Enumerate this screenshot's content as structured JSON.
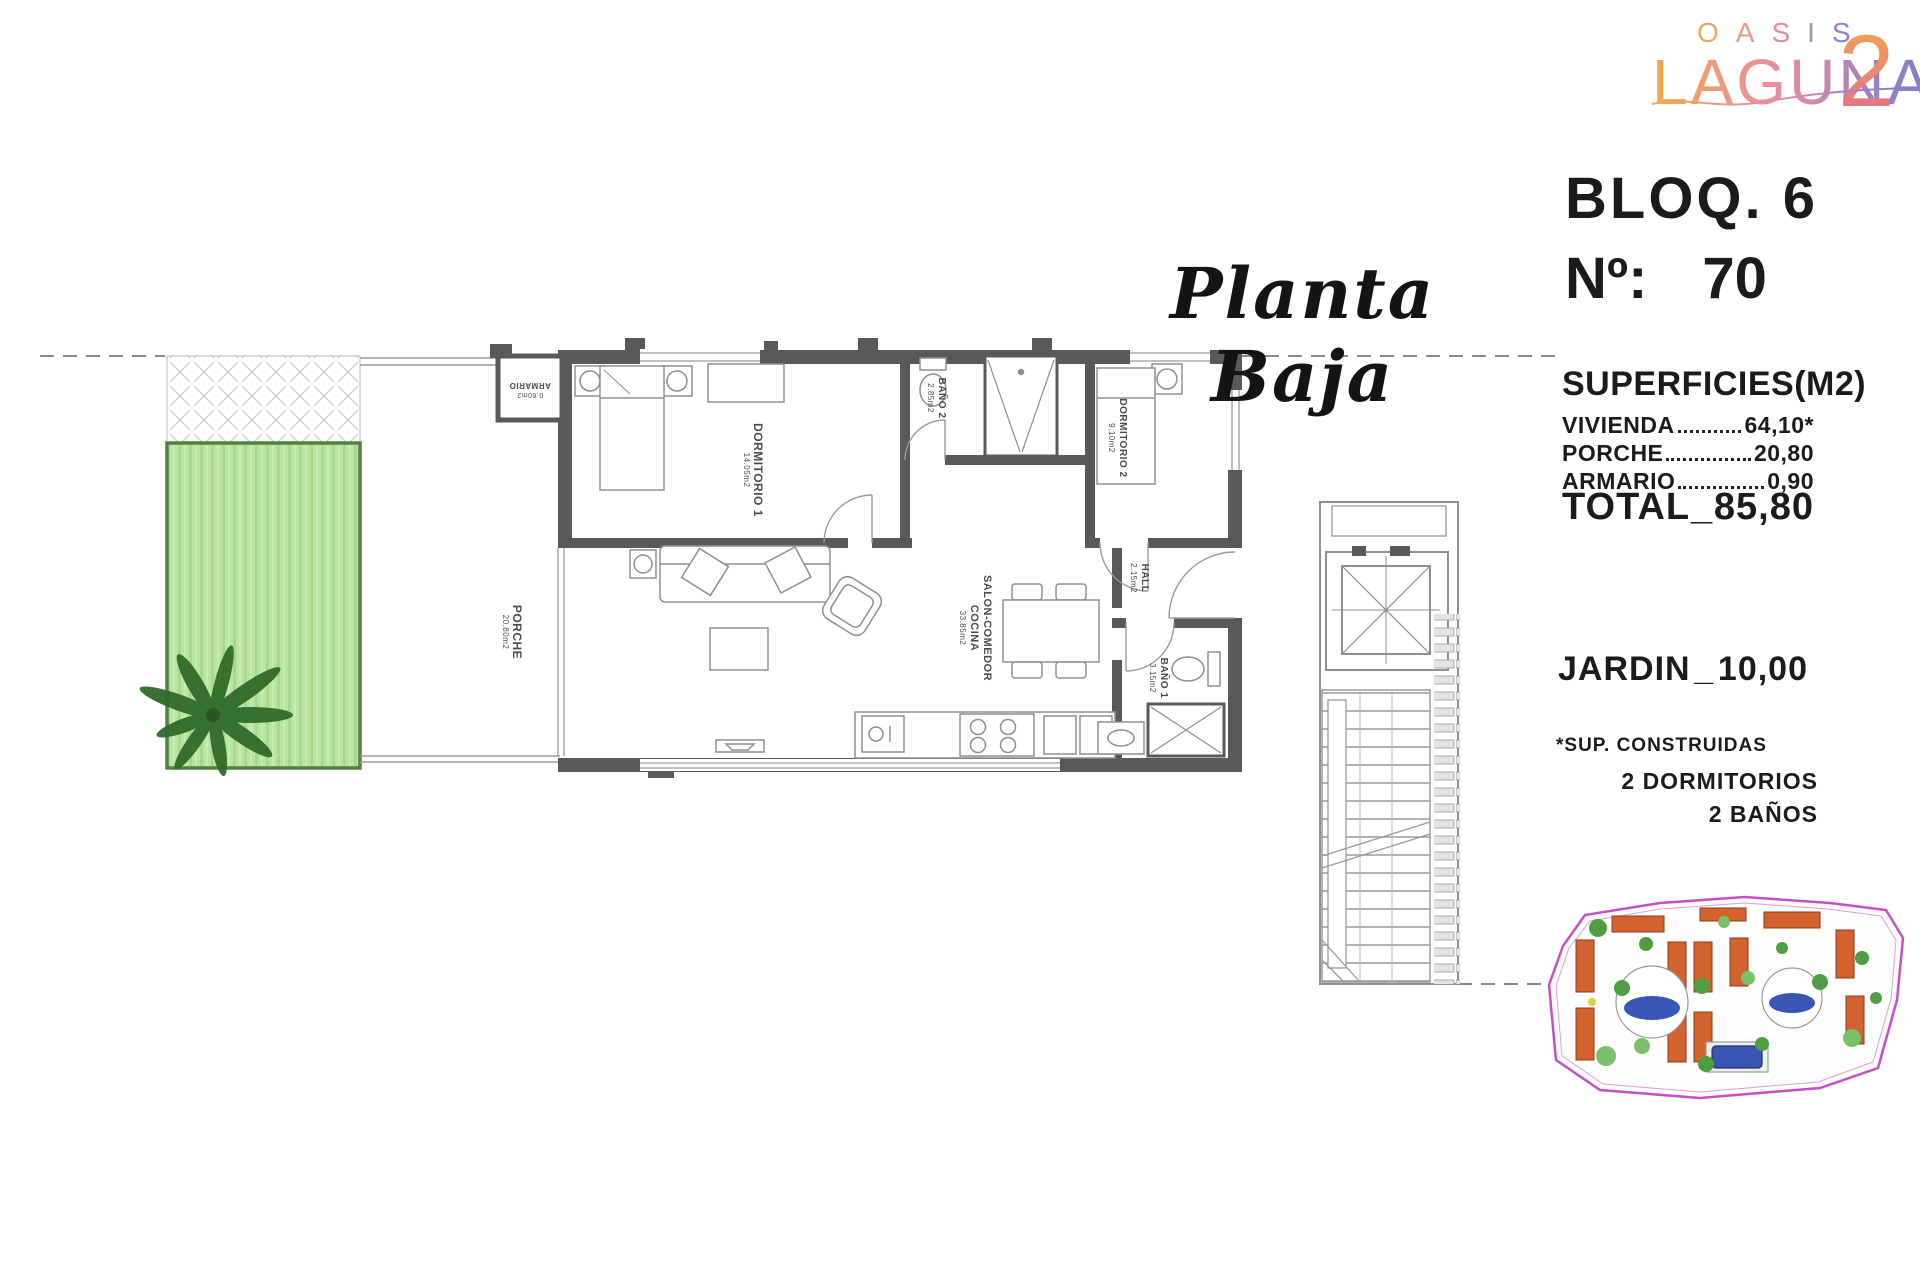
{
  "logo": {
    "word1": "OASIS",
    "word2": "LAGUNA",
    "number": "2"
  },
  "title": {
    "plan": "Planta Baja"
  },
  "unit_panel": {
    "block": "BLOQ. 6",
    "number_label": "Nº:",
    "number": "70"
  },
  "surfaces": {
    "header": "SUPERFICIES(M2)",
    "rows": [
      {
        "label": "VIVIENDA",
        "value": "64,10*"
      },
      {
        "label": "PORCHE",
        "value": "20,80"
      },
      {
        "label": "ARMARIO",
        "value": "0,90"
      }
    ],
    "total": {
      "label": "TOTAL",
      "sep": "_",
      "value": "85,80"
    },
    "garden": {
      "label": "JARDIN",
      "sep": "_",
      "value": "10,00"
    },
    "footnote": "*SUP. CONSTRUIDAS",
    "features": [
      "2 DORMITORIOS",
      "2 BAÑOS"
    ]
  },
  "rooms": {
    "dormitorio1": {
      "name": "DORMITORIO 1",
      "area": "14.05m2"
    },
    "dormitorio2": {
      "name": "DORMITORIO 2",
      "area": "9.10m2"
    },
    "bano2": {
      "name": "BAÑO 2",
      "area": "2.85m2"
    },
    "bano1": {
      "name": "BAÑO 1",
      "area": "3.15m2"
    },
    "hall": {
      "name": "HALL",
      "area": "2.15m2"
    },
    "salon": {
      "name": "SALON-COMEDOR",
      "name2": "COCINA",
      "area": "33.85m2"
    },
    "porche": {
      "name": "PORCHE",
      "area": "20.80m2"
    },
    "armario": {
      "name": "ARMARIO",
      "area": "0.60m2"
    }
  },
  "colors": {
    "wall": "#58595b",
    "garden_fill": "#b9e4a3",
    "garden_border": "#557f3f",
    "logo_orange": "#f4a94e",
    "logo_pink": "#e98da1",
    "logo_blue": "#7b7fc5",
    "siteplan_boundary": "#c74ec7",
    "siteplan_building": "#d4622e",
    "pool_blue": "#3a56b4"
  }
}
